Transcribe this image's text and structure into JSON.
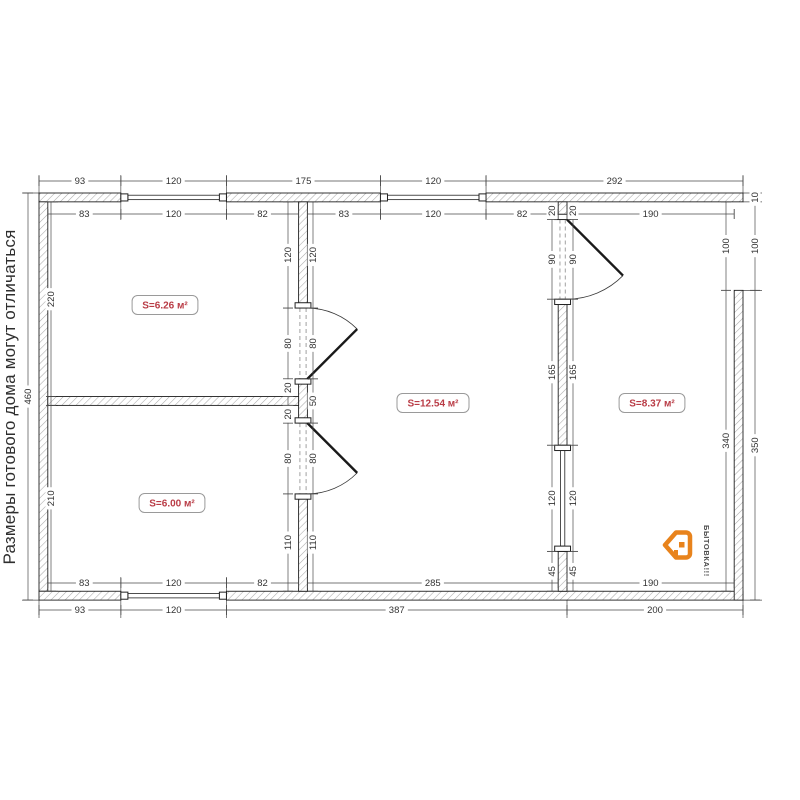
{
  "note": {
    "text": "Размеры готового дома могут отличаться"
  },
  "logo": {
    "text": "БЫТОВКА!!!",
    "icon": "house-tag-icon",
    "accent_color": "#e8831c",
    "text_color": "#4d4d4d"
  },
  "rooms": [
    {
      "label": "S=6.26 м²",
      "cx": 165,
      "cy": 305
    },
    {
      "label": "S=6.00 м²",
      "cx": 172,
      "cy": 503
    },
    {
      "label": "S=12.54 м²",
      "cx": 433,
      "cy": 403
    },
    {
      "label": "S=8.37 м²",
      "cx": 652,
      "cy": 403
    }
  ],
  "plan": {
    "ox": 39,
    "oy": 193,
    "sx": 0.88,
    "sy": 0.885,
    "colors": {
      "wall_outline": "#1f1f1f",
      "hatch": "#ababab",
      "dim": "#4a4a4a",
      "dim_text": "#333333",
      "room_text": "#b93c46",
      "room_border": "#9a9a9a",
      "dash": "#8a8a8a",
      "door": "#1a1a1a"
    },
    "walls": [
      [
        0,
        0,
        93,
        10
      ],
      [
        213,
        0,
        175,
        10
      ],
      [
        508,
        0,
        292,
        10
      ],
      [
        0,
        10,
        10,
        440
      ],
      [
        0,
        450,
        93,
        10
      ],
      [
        213,
        450,
        587,
        10
      ],
      [
        790,
        110,
        10,
        350
      ],
      [
        295,
        10,
        10,
        120
      ],
      [
        295,
        210,
        10,
        50
      ],
      [
        295,
        340,
        10,
        110
      ],
      [
        10,
        230,
        285,
        10
      ],
      [
        590,
        10,
        10,
        20
      ],
      [
        590,
        120,
        10,
        165
      ],
      [
        590,
        405,
        10,
        45
      ]
    ],
    "window_glass": [
      [
        101,
        2.5,
        104,
        5
      ],
      [
        396,
        2.5,
        104,
        5
      ],
      [
        101,
        452.5,
        104,
        5
      ],
      [
        592.5,
        291,
        5,
        108
      ]
    ],
    "window_caps": [
      [
        93,
        1,
        8,
        8
      ],
      [
        205,
        1,
        8,
        8
      ],
      [
        388,
        1,
        8,
        8
      ],
      [
        500,
        1,
        8,
        8
      ],
      [
        93,
        451,
        8,
        8
      ],
      [
        205,
        451,
        8,
        8
      ],
      [
        291,
        124,
        18,
        6
      ],
      [
        291,
        210,
        18,
        6
      ],
      [
        291,
        254,
        18,
        6
      ],
      [
        291,
        340,
        18,
        6
      ],
      [
        586,
        24,
        18,
        6
      ],
      [
        586,
        120,
        18,
        6
      ],
      [
        586,
        285,
        18,
        6
      ],
      [
        586,
        399,
        18,
        6
      ]
    ],
    "door_dashes": [
      [
        296.5,
        130,
        296.5,
        210
      ],
      [
        303.5,
        130,
        303.5,
        210
      ],
      [
        296.5,
        260,
        296.5,
        340
      ],
      [
        303.5,
        260,
        303.5,
        340
      ],
      [
        592,
        30,
        592,
        120
      ],
      [
        598,
        30,
        598,
        120
      ]
    ],
    "doors": [
      {
        "hinge": [
          305,
          210
        ],
        "end": [
          305,
          130
        ],
        "r": 80,
        "dir": [
          1,
          -1
        ],
        "sweep": 1
      },
      {
        "hinge": [
          305,
          260
        ],
        "end": [
          305,
          340
        ],
        "r": 80,
        "dir": [
          1,
          1
        ],
        "sweep": 0
      },
      {
        "hinge": [
          600,
          30
        ],
        "end": [
          600,
          120
        ],
        "r": 90,
        "dir": [
          1,
          1
        ],
        "sweep": 0
      }
    ],
    "chains": [
      {
        "dir": "h",
        "pos": 181,
        "from": 0,
        "to": 800,
        "ticks": [
          0,
          93,
          213,
          388,
          508,
          800
        ],
        "labels": [
          {
            "at": 46.5,
            "text": "93"
          },
          {
            "at": 153,
            "text": "120"
          },
          {
            "at": 300.5,
            "text": "175"
          },
          {
            "at": 448,
            "text": "120"
          },
          {
            "at": 654,
            "text": "292"
          }
        ]
      },
      {
        "dir": "h",
        "pos": 214,
        "from": 10,
        "to": 295,
        "ticks": [
          10,
          93,
          213,
          295
        ],
        "labels": [
          {
            "at": 51.5,
            "text": "83"
          },
          {
            "at": 153,
            "text": "120"
          },
          {
            "at": 254,
            "text": "82"
          }
        ]
      },
      {
        "dir": "h",
        "pos": 214,
        "from": 305,
        "to": 590,
        "ticks": [
          305,
          388,
          508,
          590
        ],
        "labels": [
          {
            "at": 346.5,
            "text": "83"
          },
          {
            "at": 448,
            "text": "120"
          },
          {
            "at": 549,
            "text": "82"
          }
        ]
      },
      {
        "dir": "h",
        "pos": 214,
        "from": 600,
        "to": 790,
        "ticks": [
          600,
          790
        ],
        "labels": [
          {
            "at": 695,
            "text": "190"
          }
        ]
      },
      {
        "dir": "h",
        "pos": 583,
        "from": 10,
        "to": 295,
        "ticks": [
          10,
          93,
          213,
          295
        ],
        "labels": [
          {
            "at": 51.5,
            "text": "83"
          },
          {
            "at": 153,
            "text": "120"
          },
          {
            "at": 254,
            "text": "82"
          }
        ]
      },
      {
        "dir": "h",
        "pos": 583,
        "from": 305,
        "to": 590,
        "ticks": [
          305,
          590
        ],
        "labels": [
          {
            "at": 447.5,
            "text": "285"
          }
        ]
      },
      {
        "dir": "h",
        "pos": 583,
        "from": 600,
        "to": 790,
        "ticks": [
          600,
          790
        ],
        "labels": [
          {
            "at": 695,
            "text": "190"
          }
        ]
      },
      {
        "dir": "h",
        "pos": 610,
        "from": 0,
        "to": 800,
        "ticks": [
          0,
          93,
          213,
          600,
          800
        ],
        "labels": [
          {
            "at": 46.5,
            "text": "93"
          },
          {
            "at": 153,
            "text": "120"
          },
          {
            "at": 406.5,
            "text": "387"
          },
          {
            "at": 700,
            "text": "200"
          }
        ]
      },
      {
        "dir": "v",
        "pos": 28,
        "from": 0,
        "to": 460,
        "ticks": [
          0,
          460
        ],
        "labels": [
          {
            "at": 230,
            "text": "460"
          }
        ]
      },
      {
        "dir": "v",
        "pos": 51,
        "from": 10,
        "to": 450,
        "ticks": [
          10,
          230,
          240,
          450
        ],
        "labels": [
          {
            "at": 120,
            "text": "220"
          },
          {
            "at": 345,
            "text": "210"
          }
        ]
      },
      {
        "dir": "v",
        "pos": 288,
        "from": 10,
        "to": 450,
        "ticks": [
          10,
          130,
          210,
          230,
          240,
          260,
          340,
          450
        ],
        "labels": [
          {
            "at": 70,
            "text": "120"
          },
          {
            "at": 170,
            "text": "80"
          },
          {
            "at": 220,
            "text": "20"
          },
          {
            "at": 250,
            "text": "20"
          },
          {
            "at": 300,
            "text": "80"
          },
          {
            "at": 395,
            "text": "110"
          }
        ]
      },
      {
        "dir": "v",
        "pos": 313,
        "from": 10,
        "to": 450,
        "ticks": [
          10,
          130,
          210,
          260,
          340,
          450
        ],
        "labels": [
          {
            "at": 70,
            "text": "120"
          },
          {
            "at": 170,
            "text": "80"
          },
          {
            "at": 235,
            "text": "50"
          },
          {
            "at": 300,
            "text": "80"
          },
          {
            "at": 395,
            "text": "110"
          }
        ]
      },
      {
        "dir": "v",
        "pos": 552,
        "from": 10,
        "to": 450,
        "ticks": [
          10,
          30,
          120,
          285,
          405,
          450
        ],
        "labels": [
          {
            "at": 20,
            "text": "20"
          },
          {
            "at": 75,
            "text": "90"
          },
          {
            "at": 202.5,
            "text": "165"
          },
          {
            "at": 345,
            "text": "120"
          },
          {
            "at": 427.5,
            "text": "45"
          }
        ]
      },
      {
        "dir": "v",
        "pos": 573,
        "from": 10,
        "to": 450,
        "ticks": [
          10,
          30,
          120,
          285,
          405,
          450
        ],
        "labels": [
          {
            "at": 20,
            "text": "20"
          },
          {
            "at": 75,
            "text": "90"
          },
          {
            "at": 202.5,
            "text": "165"
          },
          {
            "at": 345,
            "text": "120"
          },
          {
            "at": 427.5,
            "text": "45"
          }
        ]
      },
      {
        "dir": "v",
        "pos": 726,
        "from": 10,
        "to": 450,
        "ticks": [
          10,
          110,
          450
        ],
        "labels": [
          {
            "at": 60,
            "text": "100"
          },
          {
            "at": 280,
            "text": "340"
          }
        ]
      },
      {
        "dir": "v",
        "pos": 755,
        "from": 0,
        "to": 460,
        "ticks": [
          0,
          10,
          110,
          460
        ],
        "labels": [
          {
            "at": 5,
            "text": "10"
          },
          {
            "at": 60,
            "text": "100"
          },
          {
            "at": 285,
            "text": "350"
          }
        ]
      }
    ],
    "vexts": [
      [
        0,
        175,
        193
      ],
      [
        93,
        175,
        220
      ],
      [
        213,
        175,
        220
      ],
      [
        388,
        175,
        220
      ],
      [
        508,
        175,
        220
      ],
      [
        800,
        175,
        193
      ],
      [
        93,
        577,
        618
      ],
      [
        213,
        577,
        618
      ],
      [
        0,
        600,
        618
      ],
      [
        800,
        600,
        618
      ],
      [
        600,
        591,
        618
      ]
    ],
    "hexts": [
      [
        0,
        22,
        39
      ],
      [
        460,
        22,
        39
      ],
      [
        10,
        44,
        58
      ],
      [
        230,
        44,
        58
      ],
      [
        240,
        44,
        58
      ],
      [
        450,
        44,
        58
      ],
      [
        0,
        743,
        762
      ],
      [
        10,
        743,
        762
      ],
      [
        110,
        734,
        762
      ],
      [
        460,
        743,
        762
      ]
    ]
  }
}
